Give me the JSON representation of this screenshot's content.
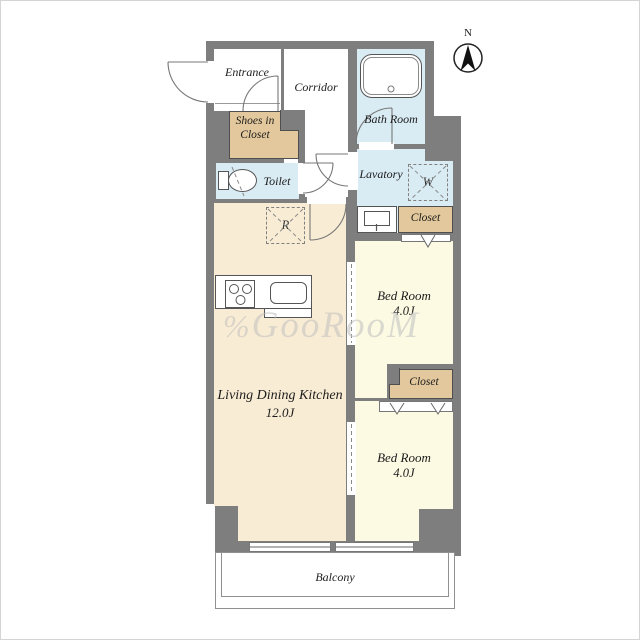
{
  "compass": {
    "label": "N"
  },
  "watermark": {
    "logo": "%",
    "text": "GooRooM"
  },
  "rooms": {
    "entrance": {
      "label": "Entrance"
    },
    "corridor": {
      "label": "Corridor"
    },
    "bath_room": {
      "label": "Bath Room"
    },
    "shoes_in_closet": {
      "line1": "Shoes in",
      "line2": "Closet"
    },
    "toilet": {
      "label": "Toilet"
    },
    "lavatory": {
      "label": "Lavatory"
    },
    "closet_upper": {
      "label": "Closet"
    },
    "bed_room_1": {
      "label": "Bed Room",
      "size": "4.0J"
    },
    "closet_lower": {
      "label": "Closet"
    },
    "bed_room_2": {
      "label": "Bed Room",
      "size": "4.0J"
    },
    "living_dining_kitchen": {
      "label": "Living Dining Kitchen",
      "size": "12.0J"
    },
    "balcony": {
      "label": "Balcony"
    }
  },
  "fixtures": {
    "washing_machine_symbol": "W",
    "refrigerator_symbol": "R"
  },
  "palette": {
    "wall": "#7e7e7e",
    "ldk_floor": "#f9ecd4",
    "bedroom_floor": "#fcfae3",
    "closet": "#e2c89c",
    "wet_area": "#d9ebf3",
    "fixture_outline": "#555555"
  }
}
